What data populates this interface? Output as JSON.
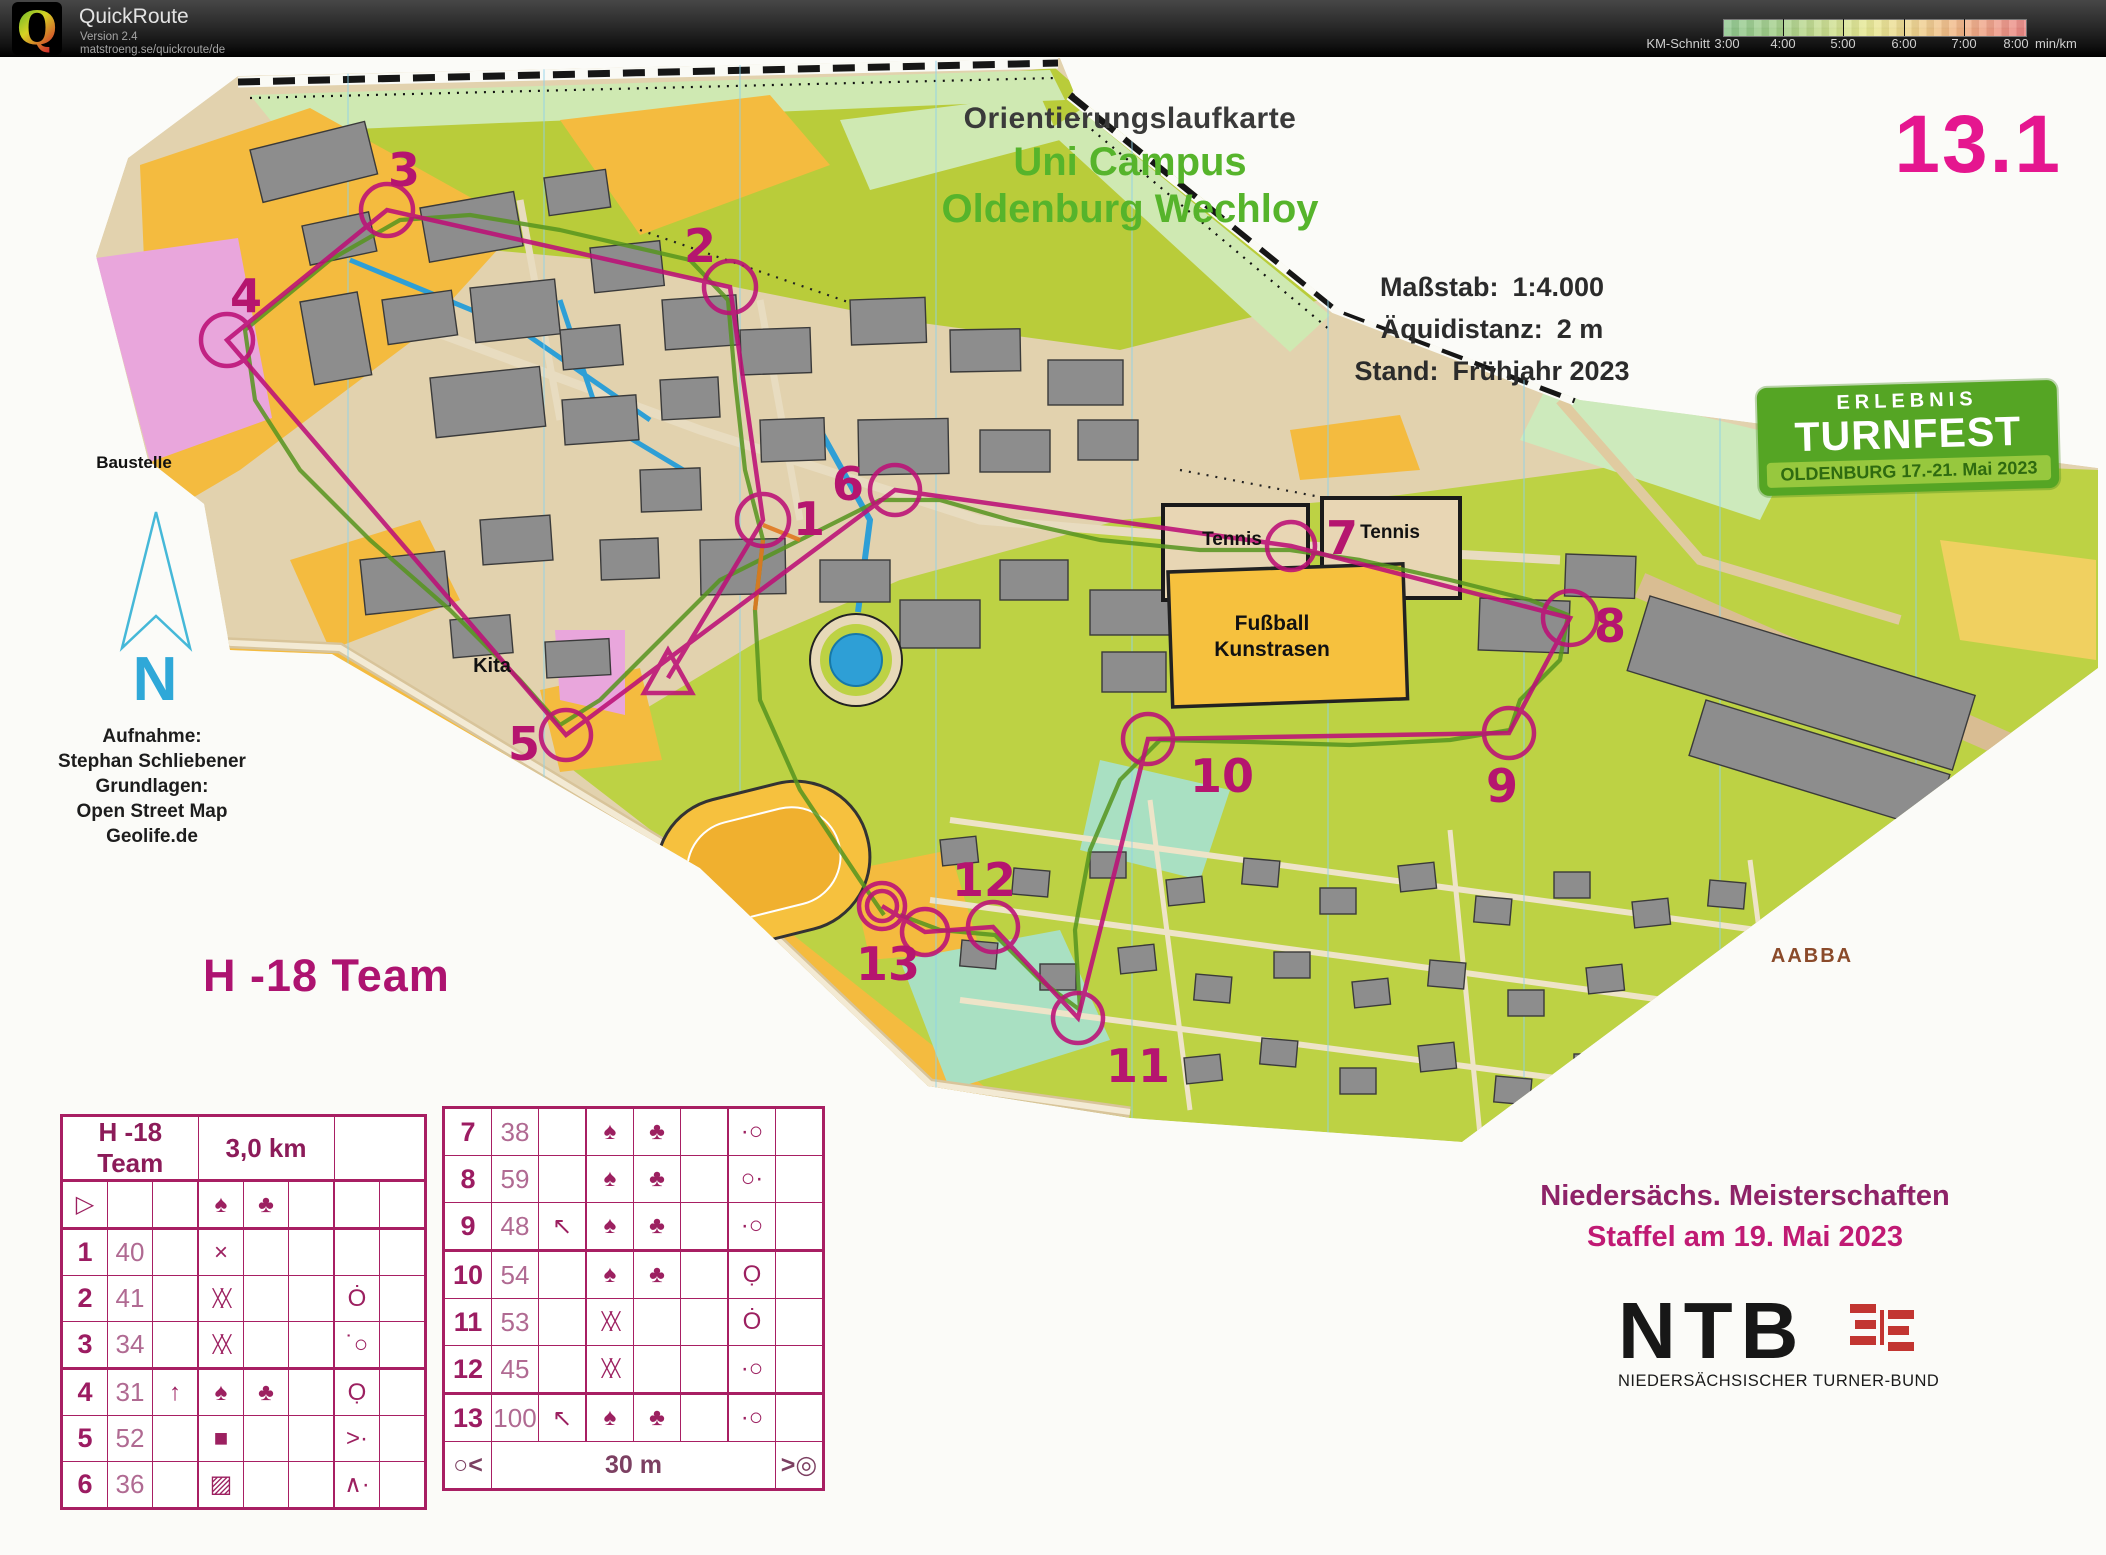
{
  "app": {
    "name": "QuickRoute",
    "version": "Version 2.4",
    "url": "matstroeng.se/quickroute/de",
    "logo_letter": "Q"
  },
  "legend": {
    "prefix": "KM-Schnitt",
    "ticks": [
      "3:00",
      "4:00",
      "5:00",
      "6:00",
      "7:00",
      "8:00"
    ],
    "unit": "min/km"
  },
  "map": {
    "number": "13.1",
    "title_line1": "Orientierungslaufkarte",
    "title_line2": "Uni Campus",
    "title_line3": "Oldenburg Wechloy",
    "scale_label": "Maßstab:",
    "scale_value": "1:4.000",
    "equidistance_label": "Äquidistanz:",
    "equidistance_value": "2 m",
    "edition_label": "Stand:",
    "edition_value": "Frühjahr 2023",
    "credits": [
      "Aufnahme:",
      "Stephan Schliebener",
      "Grundlagen:",
      "Open Street Map",
      "Geolife.de"
    ],
    "labels": {
      "baustelle": "Baustelle",
      "kita": "Kita",
      "tennis_a": "Tennis",
      "tennis_b": "Tennis",
      "fussball_line1": "Fußball",
      "fussball_line2": "Kunstrasen",
      "aabba": "AABBA",
      "north": "N"
    }
  },
  "event": {
    "turnfest_line1": "ERLEBNIS",
    "turnfest_line2": "TURNFEST",
    "turnfest_line3": "OLDENBURG 17.-21. Mai 2023",
    "championship_line1": "Niedersächs. Meisterschaften",
    "championship_line2": "Staffel am 19. Mai 2023",
    "ntb_acronym": "NTB",
    "ntb_full": "NIEDERSÄCHSISCHER TURNER-BUND"
  },
  "course": {
    "name": "H -18 Team",
    "length": "3,0 km",
    "map_numbers": [
      "1",
      "2",
      "3",
      "4",
      "5",
      "6",
      "7",
      "8",
      "9",
      "10",
      "11",
      "12",
      "13"
    ]
  },
  "control_table": {
    "left_rows": [
      {
        "n": "",
        "n_sym": "start-triangle",
        "code": "",
        "c": "",
        "d": "lone-tree",
        "e": "thicket-bush",
        "f": "",
        "g": "",
        "h": ""
      },
      {
        "n": "1",
        "n_sym": "",
        "code": "40",
        "c": "",
        "d": "crossing-x",
        "e": "",
        "f": "",
        "g": "",
        "h": ""
      },
      {
        "n": "2",
        "n_sym": "",
        "code": "41",
        "c": "",
        "d": "thicket-hatch",
        "e": "",
        "f": "",
        "g": "circle-tick",
        "h": ""
      },
      {
        "n": "3",
        "n_sym": "",
        "code": "34",
        "c": "",
        "d": "thicket-hatch",
        "e": "",
        "f": "",
        "g": "dot-circle-nw",
        "h": ""
      },
      {
        "n": "4",
        "n_sym": "",
        "code": "31",
        "c": "arrow-up",
        "d": "lone-tree",
        "e": "thicket-bush",
        "f": "",
        "g": "circle-dot-s",
        "h": ""
      },
      {
        "n": "5",
        "n_sym": "",
        "code": "52",
        "c": "",
        "d": "paved-area",
        "e": "",
        "f": "",
        "g": "junction-dot",
        "h": ""
      },
      {
        "n": "6",
        "n_sym": "",
        "code": "36",
        "c": "",
        "d": "building-hatch",
        "e": "",
        "f": "",
        "g": "bend-dot",
        "h": ""
      }
    ],
    "right_rows": [
      {
        "n": "7",
        "code": "38",
        "c": "",
        "d": "lone-tree",
        "e": "thicket-bush",
        "f": "",
        "g": "dot-circle-left",
        "h": ""
      },
      {
        "n": "8",
        "code": "59",
        "c": "",
        "d": "lone-tree",
        "e": "thicket-bush",
        "f": "",
        "g": "circle-dot-right",
        "h": ""
      },
      {
        "n": "9",
        "code": "48",
        "c": "arrow-up-left",
        "d": "lone-tree",
        "e": "thicket-bush",
        "f": "",
        "g": "dot-circle-left",
        "h": ""
      },
      {
        "n": "10",
        "code": "54",
        "c": "",
        "d": "lone-tree",
        "e": "thicket-bush",
        "f": "",
        "g": "circle-dot-sw",
        "h": ""
      },
      {
        "n": "11",
        "code": "53",
        "c": "",
        "d": "thicket-hatch",
        "e": "",
        "f": "",
        "g": "circle-tick",
        "h": ""
      },
      {
        "n": "12",
        "code": "45",
        "c": "",
        "d": "thicket-hatch",
        "e": "",
        "f": "",
        "g": "dot-circle-left",
        "h": ""
      },
      {
        "n": "13",
        "code": "100",
        "c": "arrow-up-left",
        "d": "lone-tree",
        "e": "thicket-bush",
        "f": "",
        "g": "dot-circle-left",
        "h": ""
      }
    ],
    "footer": {
      "left_icon": "taped-start",
      "label": "30 m",
      "right_icon": "taped-finish"
    }
  },
  "icon_glyphs": {
    "start-triangle": "▷",
    "lone-tree": "♠",
    "thicket-bush": "♣",
    "crossing-x": "×",
    "thicket-hatch": "╳╳",
    "paved-area": "■",
    "building-hatch": "▨",
    "arrow-up": "↑",
    "arrow-up-left": "↖",
    "circle-tick": "Ȯ",
    "dot-circle-nw": "˙○",
    "circle-dot-s": "Ọ",
    "junction-dot": ">·",
    "bend-dot": "∧·",
    "dot-circle-left": "·○",
    "circle-dot-right": "○·",
    "circle-dot-sw": "Ọ",
    "taped-start": "○<",
    "taped-finish": ">◎"
  },
  "colors": {
    "course_magenta": "#bc1077",
    "title_green": "#56b42b",
    "turnfest_green": "#55a524",
    "map_number_pink": "#e5168f",
    "legend_green": "#86c386",
    "legend_red": "#e97f7c",
    "water_blue": "#2e9fd6",
    "pace_orange": "#e07820"
  }
}
